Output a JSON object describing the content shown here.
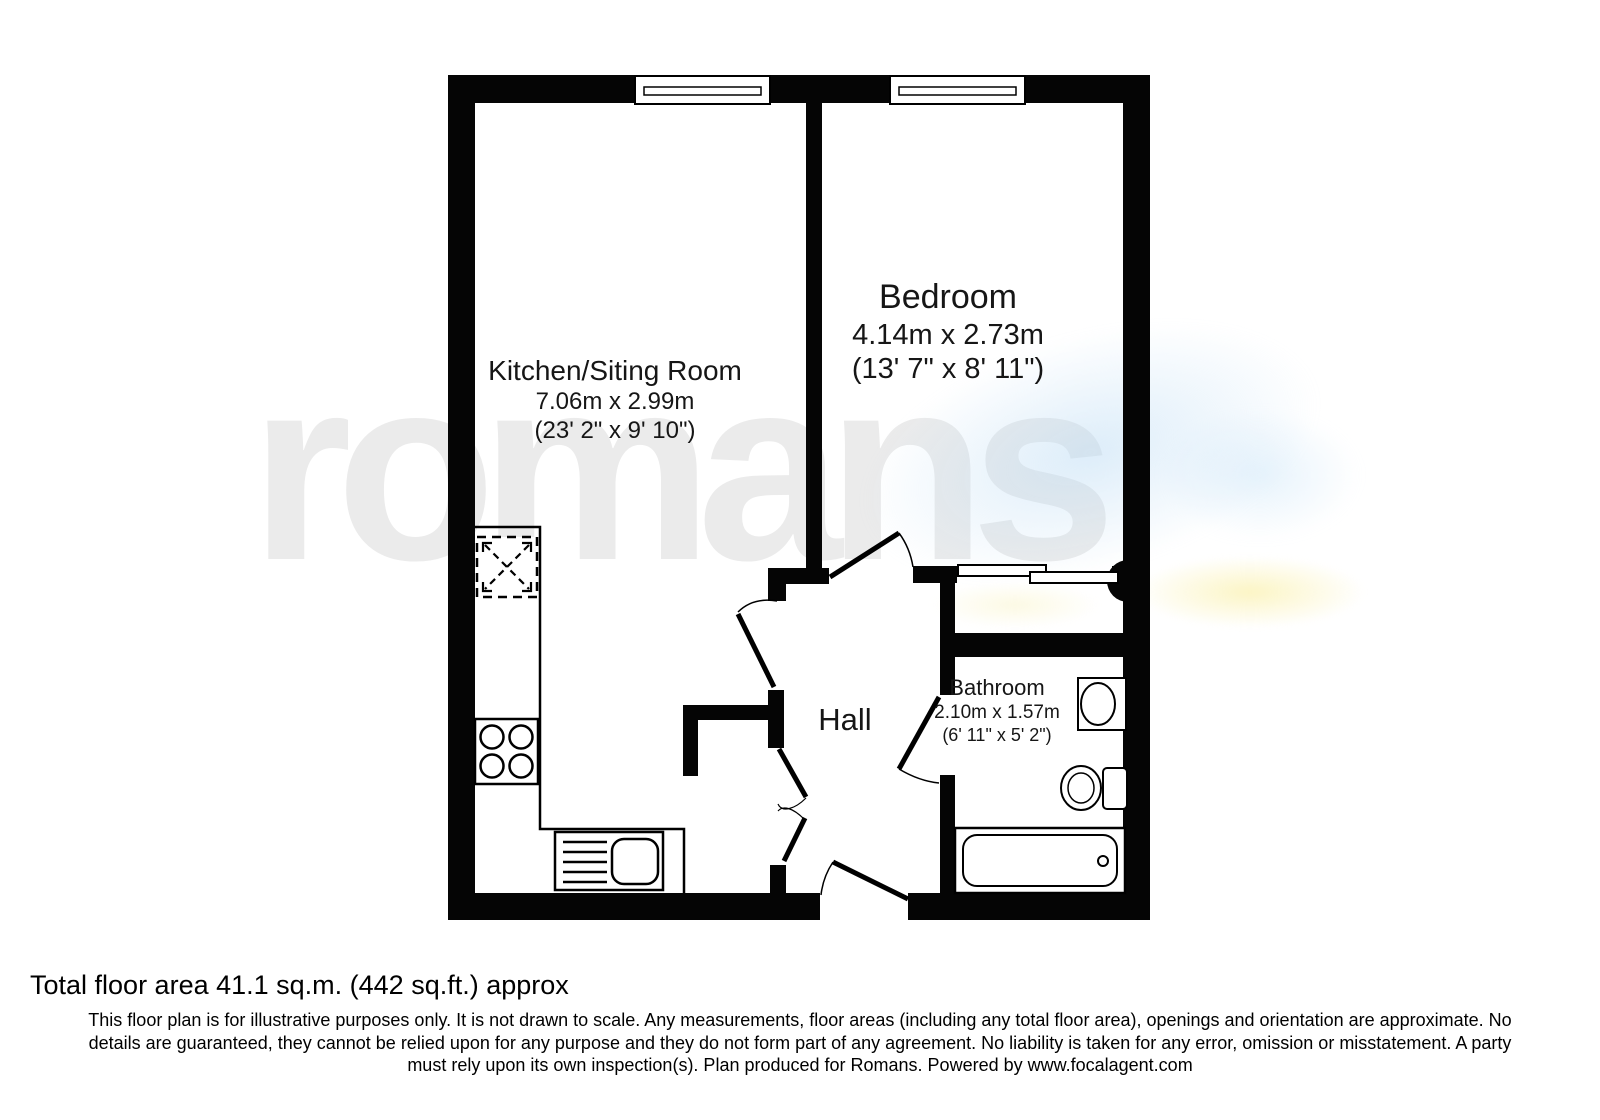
{
  "watermark": "romans",
  "rooms": {
    "kitchen": {
      "name": "Kitchen/Siting Room",
      "dims_metric": "7.06m x 2.99m",
      "dims_imperial": "(23' 2\" x 9' 10\")"
    },
    "bedroom": {
      "name": "Bedroom",
      "dims_metric": "4.14m x 2.73m",
      "dims_imperial": "(13' 7\" x 8' 11\")"
    },
    "bathroom": {
      "name": "Bathroom",
      "dims_metric": "2.10m x 1.57m",
      "dims_imperial": "(6' 11\" x 5' 2\")"
    },
    "hall": {
      "name": "Hall"
    }
  },
  "footer": {
    "total_area": "Total floor area 41.1 sq.m. (442 sq.ft.) approx",
    "disclaimer_lines": [
      "This floor plan is for illustrative purposes only. It is not drawn to scale. Any measurements, floor areas (including any total floor area), openings and orientation are approximate. No",
      "details are guaranteed, they cannot be relied upon for any purpose and they do not form part of any agreement. No liability is taken for any error, omission or misstatement. A party",
      "must rely upon its own inspection(s). Plan produced for Romans. Powered by www.focalagent.com"
    ]
  },
  "colors": {
    "wall": "#050505",
    "watermark": "#ebebeb",
    "text": "#161616"
  }
}
